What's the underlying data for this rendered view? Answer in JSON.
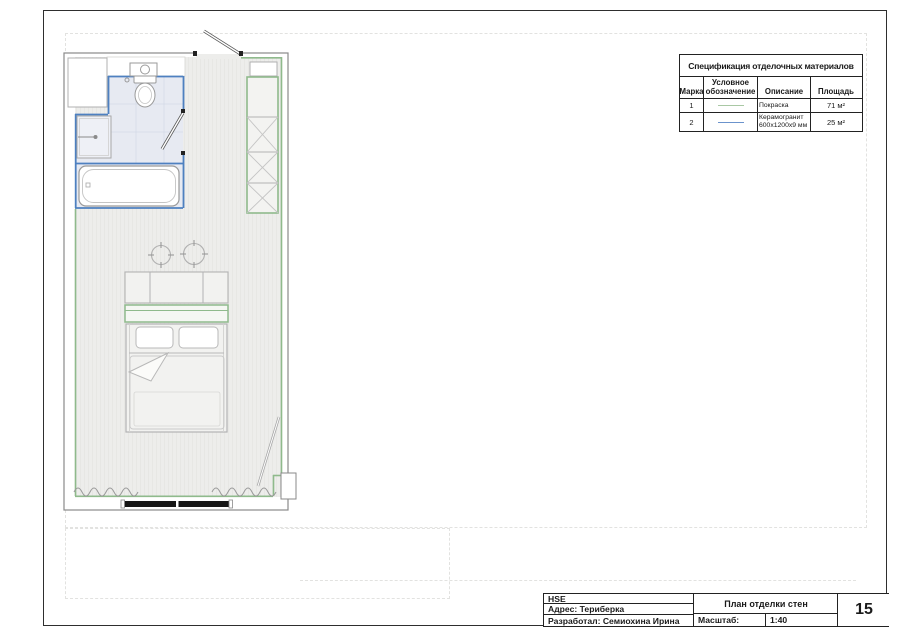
{
  "spec_table": {
    "title": "Спецификация отделочных материалов",
    "columns": {
      "mark": "Марка",
      "symbol": "Условное обозначение",
      "description": "Описание",
      "area": "Площадь"
    },
    "rows": [
      {
        "mark": "1",
        "symbol_name": "paint-line-symbol",
        "symbol_color": "#a9c8a4",
        "description": "Покраска",
        "description2": "",
        "area": "71 м²"
      },
      {
        "mark": "2",
        "symbol_name": "tile-line-symbol",
        "symbol_color": "#6b93cc",
        "description": "Керамогранит",
        "description2": "600х1200х9 мм",
        "area": "25 м²"
      }
    ]
  },
  "title_block": {
    "organization": "HSE",
    "address": "Адрес:  Териберка",
    "developer": "Разработал: Семиохина Ирина",
    "drawing_title": "План отделки стен",
    "scale_label": "Масштаб:",
    "scale_value": "1:40",
    "sheet_number": "15"
  },
  "plan": {
    "finish_colors": {
      "paint_green": "#8fba8c",
      "ceramic_blue": "#4e80c0"
    },
    "fixtures": [
      "entrance-door",
      "bathroom-door",
      "washbasin",
      "toilet",
      "shower",
      "bathtub",
      "storage-cabinet",
      "wardrobe",
      "ceiling-spotlights",
      "headboard-sofa",
      "console-shelf",
      "double-bed",
      "pillows",
      "curtains",
      "window",
      "floor-lamp"
    ]
  }
}
